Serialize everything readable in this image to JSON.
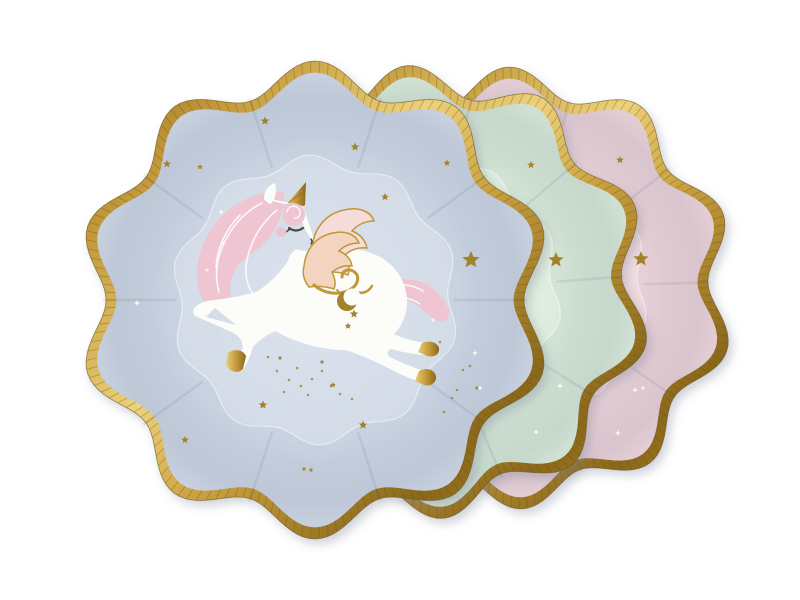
{
  "meta": {
    "type": "product-photo",
    "plate_count": 3,
    "description": "Three pastel scalloped paper party plates with wavy gold foil rims on a white background: a light blue plate in front decorated with a leaping white unicorn pegasus with a gold foil horn, pink wavy mane and tail, peach gold-edged wings, gold hooves, a gold crescent moon and scattered gold stars; a mint green plate and a pale pink plate behind it, each sprinkled with small gold foil stars and white sparkles."
  },
  "colors": {
    "background": "#ffffff",
    "gold_light": "#ecd27b",
    "gold_mid": "#c09739",
    "gold_dark": "#8a681c",
    "gold_deep": "#6f5a16",
    "gold_star": "#a3832c",
    "blue_rim": "#cad4e2",
    "blue_well": "#d5dde9",
    "mint_rim": "#d4e6d6",
    "mint_well": "#dfeede",
    "pink_rim": "#e9d1d8",
    "pink_well": "#f1dbe0",
    "unicorn_white": "#fcfcf9",
    "mane_pink": "#eec5d1",
    "wing_peach": "#f3d4bf",
    "wing_pale": "#f6dcd9",
    "blush": "#f0bfca",
    "eye": "#4a433e",
    "sparkle": "#ffffff"
  },
  "plates": [
    {
      "id": "pink",
      "label": "pale pink plate",
      "position": "back",
      "rim": "#e9d1d8",
      "well": "#f1dbe0",
      "gold_stars": [
        [
          620,
          160,
          4
        ],
        [
          641,
          259,
          8
        ]
      ],
      "sparkles": [
        [
          635,
          390,
          3
        ],
        [
          643,
          388,
          2.5
        ],
        [
          618,
          433,
          3.5
        ]
      ],
      "speckles": []
    },
    {
      "id": "mint",
      "label": "mint green plate",
      "position": "middle",
      "rim": "#d4e6d6",
      "well": "#dfeede",
      "gold_stars": [
        [
          531,
          165,
          4
        ],
        [
          556,
          260,
          8
        ]
      ],
      "sparkles": [
        [
          530,
          388,
          3
        ],
        [
          560,
          386,
          3.5
        ],
        [
          536,
          432,
          3
        ]
      ],
      "speckles": []
    },
    {
      "id": "blue",
      "label": "light blue unicorn plate",
      "position": "front",
      "rim": "#cad4e2",
      "well": "#d5dde9",
      "gold_stars": [
        [
          265,
          121,
          4.5
        ],
        [
          355,
          147,
          4.5
        ],
        [
          447,
          163,
          3.5
        ],
        [
          167,
          164,
          4
        ],
        [
          200,
          167,
          3
        ],
        [
          385,
          197,
          4
        ],
        [
          471,
          260,
          9
        ],
        [
          280,
          358,
          2.5
        ],
        [
          322,
          362,
          2.5
        ],
        [
          263,
          405,
          4.5
        ],
        [
          185,
          440,
          4
        ],
        [
          363,
          425,
          4.5
        ],
        [
          333,
          385,
          3
        ],
        [
          304,
          469,
          2.5
        ],
        [
          311,
          470,
          2.5
        ],
        [
          477,
          388,
          2.5
        ]
      ],
      "sparkles": [
        [
          137,
          303,
          3.5
        ],
        [
          475,
          353,
          3
        ],
        [
          480,
          388,
          3
        ]
      ],
      "speckles": [
        [
          268,
          357
        ],
        [
          277,
          371
        ],
        [
          289,
          380
        ],
        [
          301,
          386
        ],
        [
          312,
          379
        ],
        [
          297,
          368
        ],
        [
          284,
          392
        ],
        [
          308,
          395
        ],
        [
          322,
          371
        ],
        [
          331,
          386
        ],
        [
          340,
          394
        ],
        [
          352,
          399
        ],
        [
          440,
          342
        ],
        [
          463,
          370
        ],
        [
          457,
          390
        ],
        [
          452,
          398
        ],
        [
          444,
          412
        ],
        [
          470,
          366
        ]
      ]
    }
  ],
  "unicorn": {
    "label": "leaping unicorn pegasus illustration",
    "features": [
      "gold foil horn",
      "closed eye",
      "pink blush cheek",
      "pink wavy mane",
      "pink wavy tail",
      "peach wings with gold feather curls",
      "gold hooves",
      "gold crescent moon on hip",
      "gold hip stars",
      "white sparkle stars in mane and tail"
    ],
    "hip_stars": [
      [
        354,
        314,
        4.5
      ],
      [
        348,
        326,
        3.5
      ]
    ],
    "mane_stars": [
      [
        221,
        212,
        3
      ],
      [
        223,
        243,
        2.5
      ],
      [
        207,
        270,
        2.5
      ]
    ],
    "tail_stars": [
      [
        376,
        292,
        2.5
      ],
      [
        433,
        320,
        2.5
      ]
    ]
  }
}
